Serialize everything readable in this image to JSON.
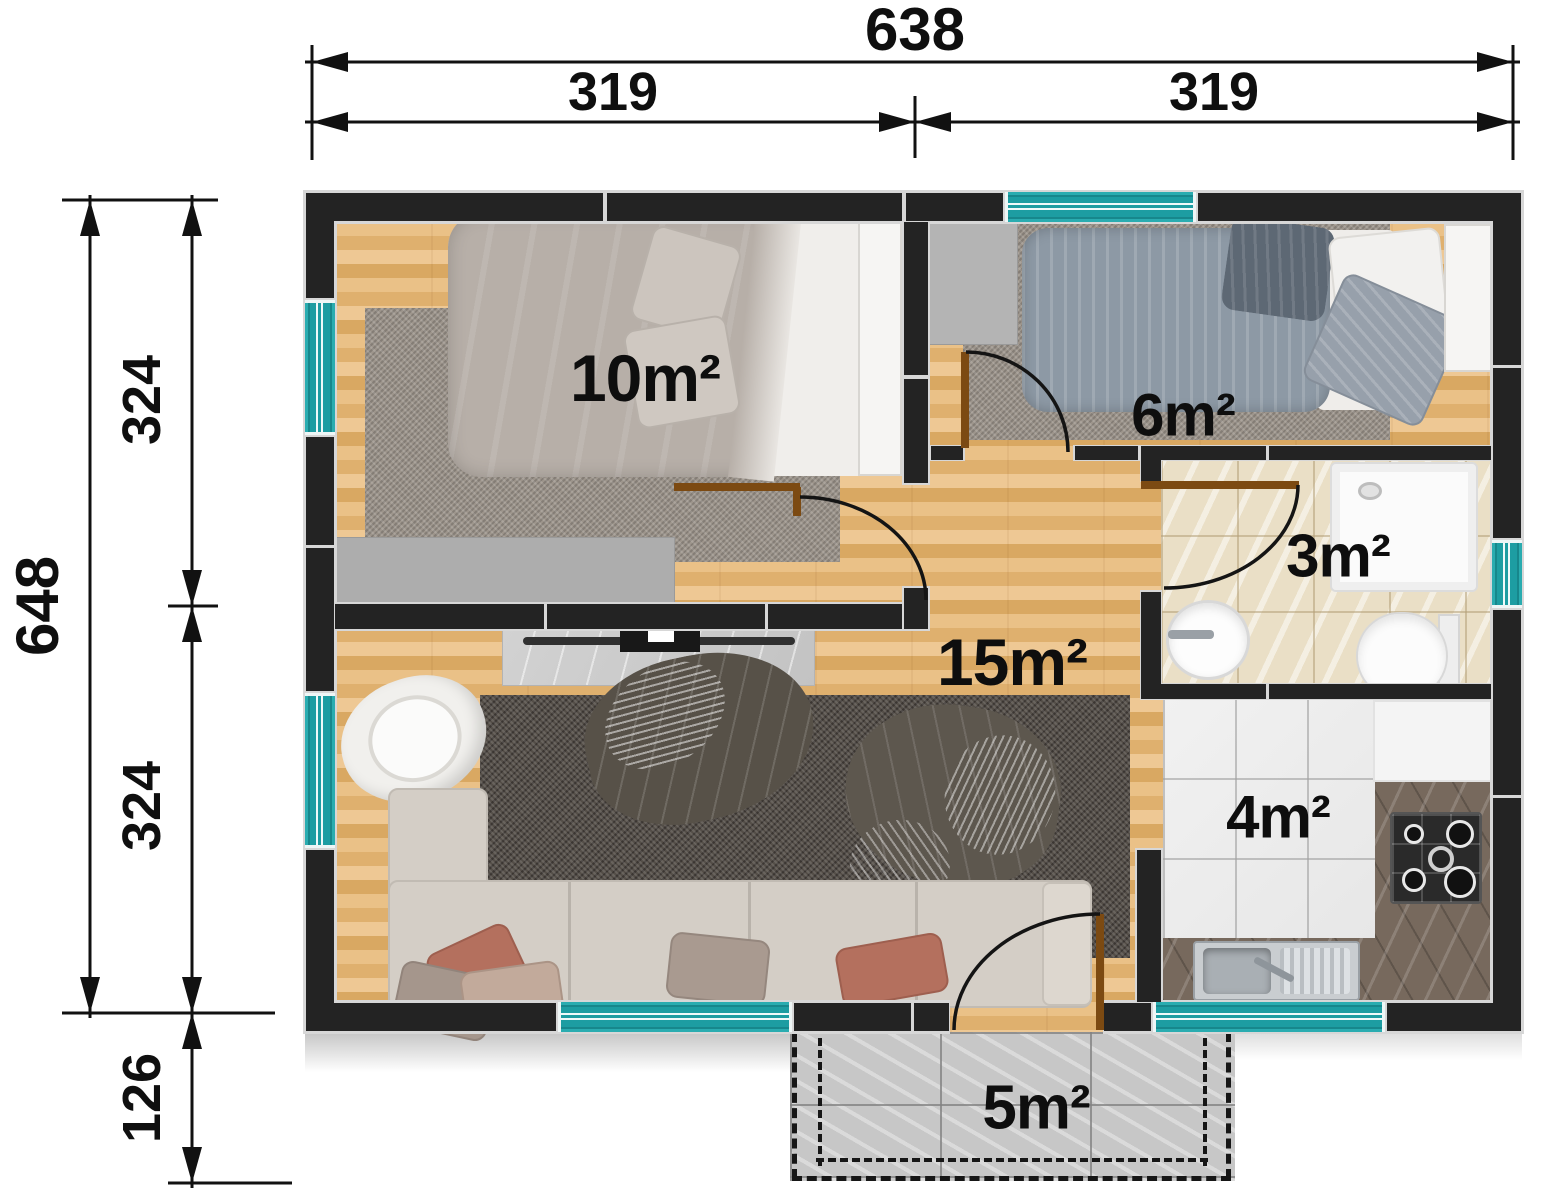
{
  "rooms": [
    {
      "id": "bedroom-1",
      "area": "10m²"
    },
    {
      "id": "bedroom-2",
      "area": "6m²"
    },
    {
      "id": "bathroom",
      "area": "3m²"
    },
    {
      "id": "living-room",
      "area": "15m²"
    },
    {
      "id": "kitchen",
      "area": "4m²"
    },
    {
      "id": "terrace",
      "area": "5m²"
    }
  ],
  "dimensions": {
    "width_total": "638",
    "width_left": "319",
    "width_right": "319",
    "height_total": "648",
    "height_upper": "324",
    "height_lower": "324",
    "terrace_depth": "126"
  },
  "colors": {
    "wall": "#232323",
    "window": "#1d9da2",
    "wood_floor": "#e6bb82",
    "dimension_ink": "#111111"
  }
}
